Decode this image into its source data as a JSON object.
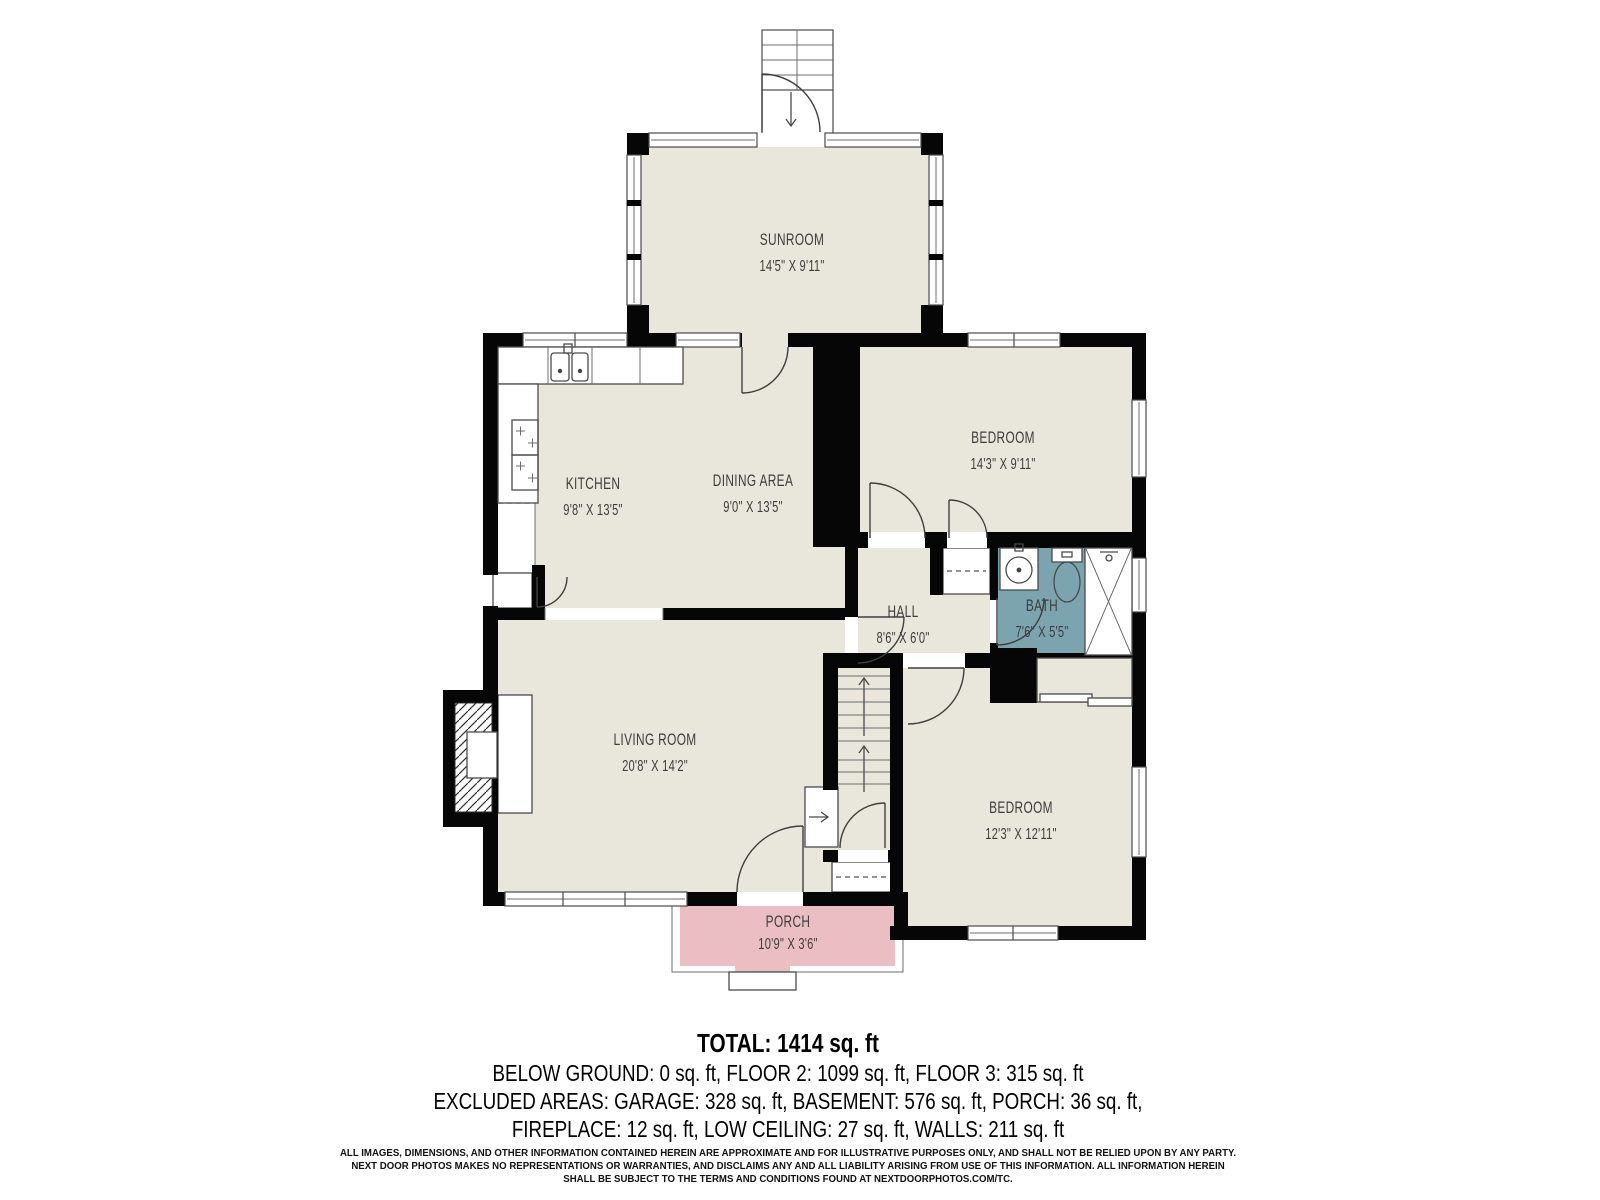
{
  "plan": {
    "rooms": [
      {
        "name": "SUNROOM",
        "dims": "14'5\" X 9'11\""
      },
      {
        "name": "KITCHEN",
        "dims": "9'8\" X 13'5\""
      },
      {
        "name": "DINING AREA",
        "dims": "9'0\" X 13'5\""
      },
      {
        "name": "BEDROOM",
        "dims": "14'3\" X 9'11\""
      },
      {
        "name": "HALL",
        "dims": "8'6\" X 6'0\""
      },
      {
        "name": "BATH",
        "dims": "7'6\" X 5'5\""
      },
      {
        "name": "LIVING ROOM",
        "dims": "20'8\" X 14'2\""
      },
      {
        "name": "BEDROOM",
        "dims": "12'3\" X 12'11\""
      },
      {
        "name": "PORCH",
        "dims": "10'9\" X 3'6\""
      }
    ],
    "colors": {
      "floor": "#e9e7dc",
      "bath": "#7ca4af",
      "porch": "#eabec2",
      "wall": "#060606",
      "label": "#3d3d3d"
    }
  },
  "areas": {
    "total_sqft": 1414,
    "below_ground_sqft": 0,
    "floor2_sqft": 1099,
    "floor3_sqft": 315,
    "garage_sqft": 328,
    "basement_sqft": 576,
    "porch_sqft": 36,
    "fireplace_sqft": 12,
    "low_ceiling_sqft": 27,
    "walls_sqft": 211
  },
  "summary": {
    "total": "TOTAL: 1414 sq. ft",
    "floors": "BELOW GROUND: 0 sq. ft, FLOOR 2: 1099 sq. ft, FLOOR 3: 315 sq. ft",
    "excluded": "EXCLUDED AREAS: GARAGE: 328 sq. ft, BASEMENT: 576 sq. ft, PORCH: 36 sq. ft,",
    "excluded2": "FIREPLACE: 12 sq. ft, LOW CEILING: 27 sq. ft, WALLS: 211 sq. ft"
  },
  "disclaimer": {
    "line1": "ALL IMAGES, DIMENSIONS, AND OTHER INFORMATION CONTAINED HEREIN ARE APPROXIMATE AND FOR ILLUSTRATIVE PURPOSES ONLY, AND SHALL NOT BE RELIED UPON BY ANY PARTY.",
    "line2": "NEXT DOOR PHOTOS MAKES NO REPRESENTATIONS OR WARRANTIES, AND DISCLAIMS ANY AND ALL LIABILITY ARISING FROM USE OF THIS INFORMATION. ALL INFORMATION HEREIN",
    "line3": "SHALL BE SUBJECT TO THE TERMS AND CONDITIONS FOUND AT NEXTDOORPHOTOS.COM/TC."
  }
}
